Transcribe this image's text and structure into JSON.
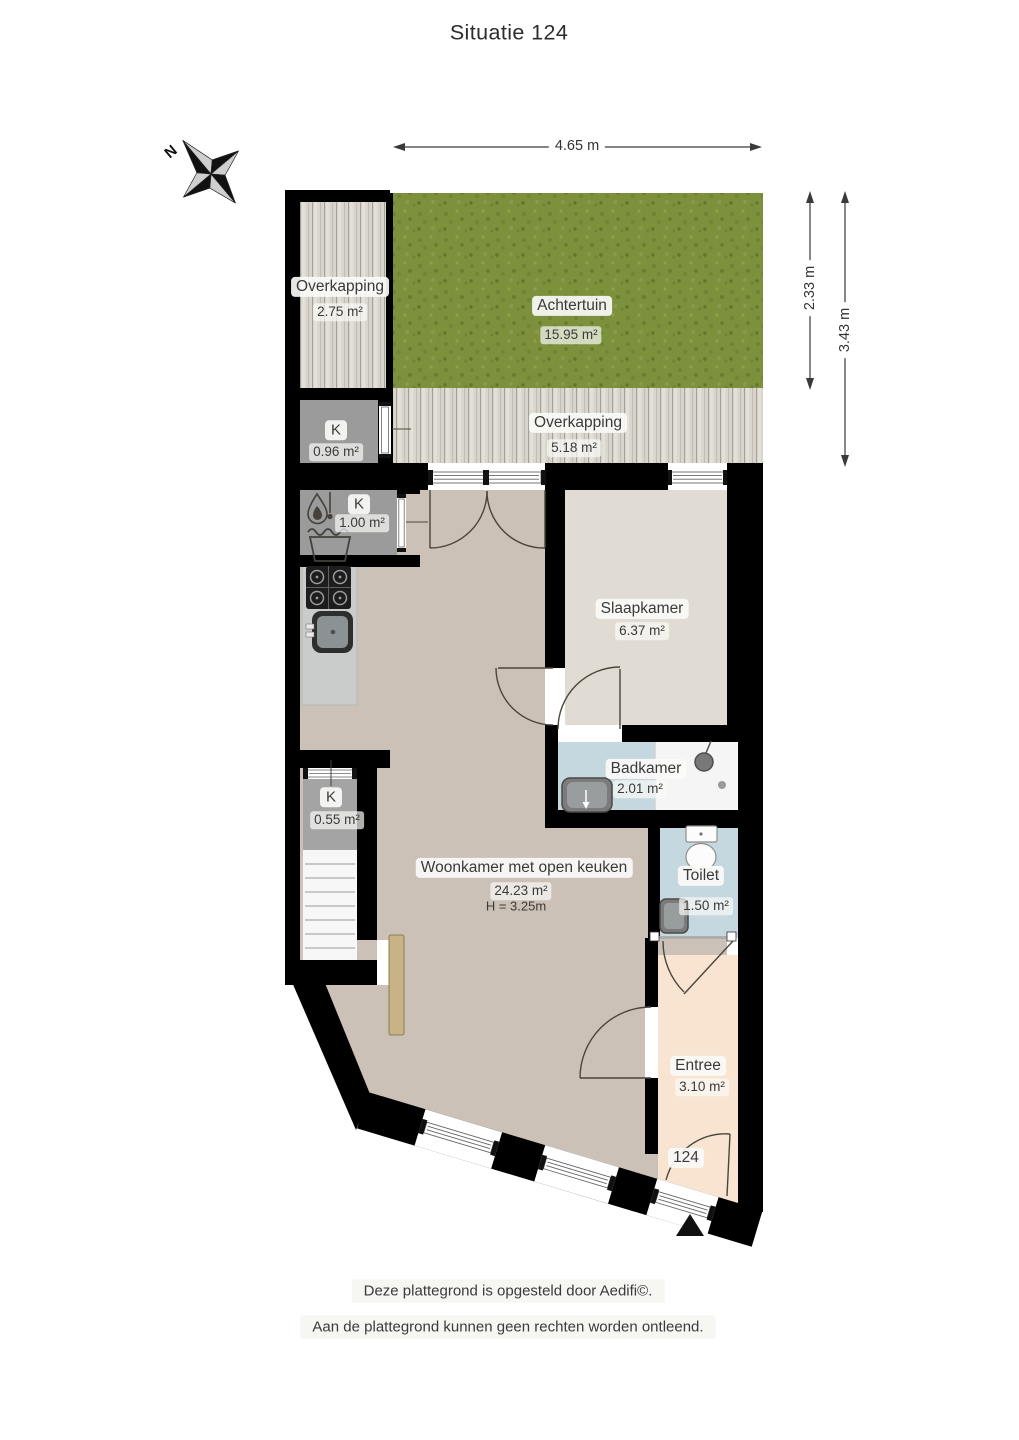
{
  "title": "Situatie 124",
  "compass": {
    "north_label": "N"
  },
  "dimensions": {
    "width_top": "4.65 m",
    "depth_garden": "2.33 m",
    "depth_garden_total": "3.43 m"
  },
  "rooms": {
    "overkapping_left": {
      "name": "Overkapping",
      "area": "2.75 m²"
    },
    "achtertuin": {
      "name": "Achtertuin",
      "area": "15.95 m²"
    },
    "overkapping_back": {
      "name": "Overkapping",
      "area": "5.18 m²"
    },
    "closet_096": {
      "name": "K",
      "area": "0.96 m²"
    },
    "closet_100": {
      "name": "K",
      "area": "1.00 m²"
    },
    "slaapkamer": {
      "name": "Slaapkamer",
      "area": "6.37 m²"
    },
    "badkamer": {
      "name": "Badkamer",
      "area": "2.01 m²"
    },
    "closet_055": {
      "name": "K",
      "area": "0.55 m²"
    },
    "woonkamer": {
      "name": "Woonkamer met open keuken",
      "area": "24.23 m²",
      "ceiling_height": "H = 3.25m"
    },
    "toilet": {
      "name": "Toilet",
      "area": "1.50 m²"
    },
    "entree": {
      "name": "Entree",
      "area": "3.10 m²"
    }
  },
  "entrance": {
    "house_number": "124"
  },
  "footer": {
    "line1": "Deze plattegrond is opgesteld door Aedifi©.",
    "line2": "Aan de plattegrond kunnen geen rechten worden ontleend."
  },
  "colors": {
    "wall": "#000000",
    "living_floor": "#cbc1b7",
    "bedroom_floor": "#e0dcd4",
    "bath_floor": "#c5d8df",
    "entry_floor": "#f8e4d0",
    "closet_floor": "#9b9b9b",
    "grass": "#7d913d",
    "decking": "#d9d5cc",
    "radiator": "#c9b285",
    "label_text": "#3a3a3a"
  }
}
